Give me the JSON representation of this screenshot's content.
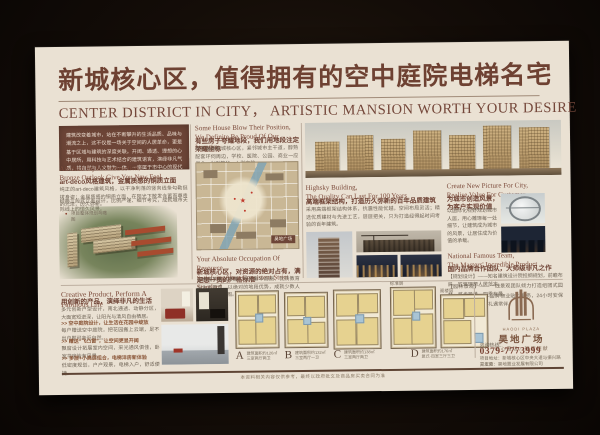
{
  "poster": {
    "title_cn": "新城核心区，值得拥有的空中庭院电梯名宅",
    "title_en": "CENTER DISTRICT IN CITY，  ARTISTIC MANSION WORTH YOUR DESIRE"
  },
  "col1": {
    "intro": "建筑改变着城市，站在不断攀升的生活品质、品味与潮流之上，这不仅是一场关于空间的人居革命，更是基于区域与建筑的深度关联。开阔、通透、理想的心中居所，用科技与艺术结合的建筑语言，演绎非凡气质，将自然与人文融为一体，一座属于市中心的现代化墅质大宅！",
    "h_en1": "Art-deco Style Construction,",
    "h_en2": "Bronze Outlook Give You New Feel",
    "h_cn": "art-deco风格建筑，金属质感的铜质立面",
    "body1": "纯正的art-deco建筑风格，以干净利落的竖向线条勾勒挺拔身姿；金属质感的铜质立面，在阳光下散发含蓄而尊贵的光泽，历久弥新。",
    "body2": "经典三段式立面设计，比例严谨、细节考究，成就城市天际线上的恒久风景。",
    "aerial_caption": "项目整体规划鸟瞰图"
  },
  "col2": {
    "h1_en1": "Some House Blow Their Position,",
    "h1_en2": "We Definite Be Proud Of Our Location",
    "h1_cn": "有些房子夸耀地段，我们用地段注定荣耀坐标",
    "body1": "项目雄踞新城核心区，紧邻城市主干道，醇熟配套环伺周边，学校、医院、公园、商业一应俱全，出则繁华，入则宁静。",
    "map_label": "昊地广场",
    "h2_en1": "Your Absolute Occupation Of Resource,",
    "h2_en2": "Satisfying Your Consistent Strict Standard",
    "h2_cn": "新城核心区，对资源的绝对占有，满足您一贯的严格标准",
    "body2": "坐拥城市核心资源，咫尺繁华商圈、优质教育与生态景观，以绝对的地段优势，成就少数人的理想生活版图。"
  },
  "col3": {
    "a_en1": "Highsky Building,",
    "a_en2": "The Quality Can Last For 100 Years",
    "a_cn": "高端框架结构，打造历久弥新的百年品质建筑",
    "a_body": "采用高端框架结构体系，抗震性能优越，空间布局灵活；精选优质建材与先进工艺，层层把关，只为打造经得起时间考验的百年建筑。",
    "b_en1": "Create New Picture For City,",
    "b_en2": "Realise Value For Customer",
    "b_cn": "为城市创造风景，为客户实现价值",
    "b_body": "以国际化视野规划城市人居，用心雕琢每一处细节，让建筑成为城市的风景，让居住成为价值的承载。",
    "c_en1": "National Famous Team,",
    "c_en2": "The Masters' Incredible Product",
    "c_cn": "国内品牌合作团队，大师级非凡之作",
    "c_p1": "【规划设计】——知名建筑设计院担纲规划，前瞻布局，匠筑理想人居范本。",
    "c_p2": "【园林景观】——一线景观团队倾力打造组团式园林，移步异景，四季有景。",
    "c_p3": "【物业服务】——品牌物业贴心服务，24小时安保体系，管家式服务礼遇常伴。"
  },
  "bottom": {
    "d_en": "Creative Product, Perform A Fabulous Life",
    "d_cn": "用创新的产品，演绎非凡的生活",
    "d_body": "多元创新户型设计，南北通透、动静分区，大面宽短进深，让阳光与清风自由栖居。",
    "bullets": [
      {
        "head": ">> 空中庭院设计，让生活在花园中绽放",
        "body": "每户赠送空中庭院，把花园搬上云端，足不出户即可亲近自然。"
      },
      {
        "head": ">> 赠送“飞凸窗”，让空间更显开阔",
        "body": "飘窗设计拓展室内空间，采光通风俱佳，卧室书房皆有风景。"
      },
      {
        "head": ">> 多层+小高层组合，电梯洋房新体验",
        "body": "低密度规划，户户观景，电梯入户，舒适便捷。"
      }
    ],
    "plans": [
      {
        "letter": "A",
        "area": "建筑面积约126㎡",
        "type": "三室两厅两卫"
      },
      {
        "letter": "B",
        "area": "建筑面积约132㎡",
        "type": "三室两厅一卫"
      },
      {
        "letter": "C",
        "area": "建筑面积约138㎡",
        "type": "三室两厅两卫"
      },
      {
        "letter": "D",
        "area": "建筑面积约176㎡",
        "type": "复式·四室三厅三卫"
      }
    ],
    "d_floor1": "标准层",
    "d_floor2": "阁楼层"
  },
  "logo": {
    "en": "HAODI PLAZA",
    "cn": "昊地广场",
    "slogan": "市心藏珑，臻席钜献",
    "hotline_label": "咨询热线：",
    "phone": "0379-7773999",
    "address1": "项目地址：新城核心区中央大道与振兴路交汇处",
    "address2": "开发商：昊地置业发展有限公司",
    "footnote": "本资料相关内容仅供参考，最终以政府批文及商品房买卖合同为准"
  }
}
